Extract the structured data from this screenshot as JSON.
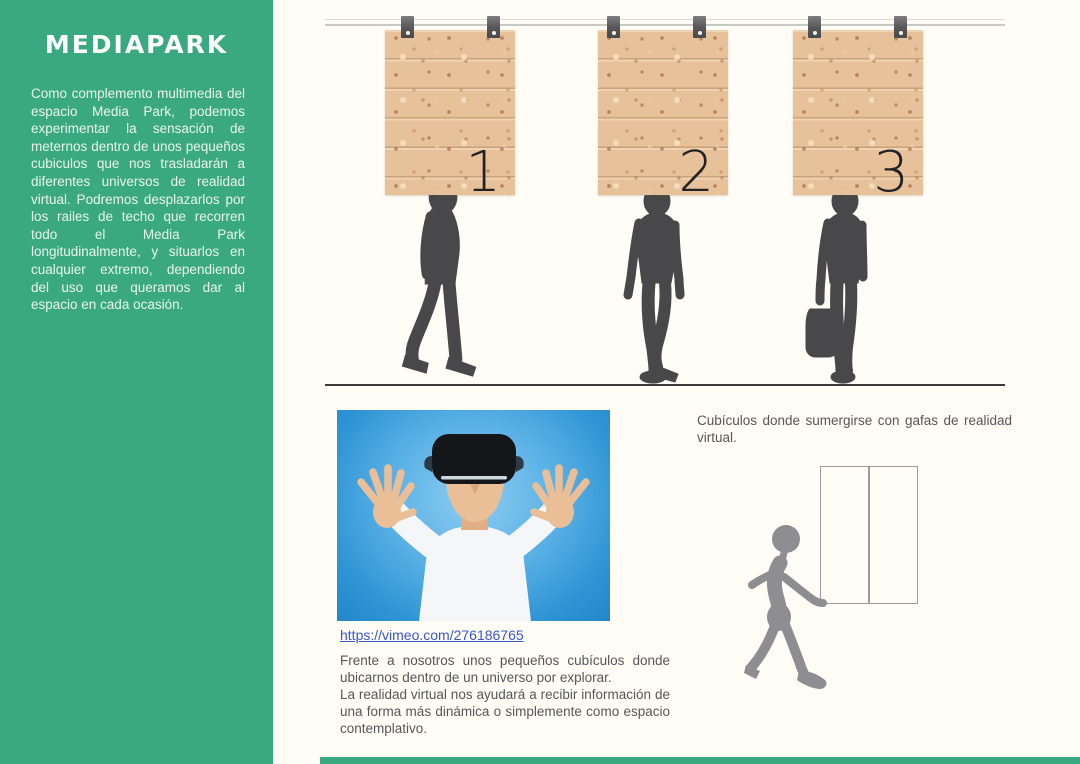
{
  "sidebar": {
    "title": "MEDIAPARK",
    "paragraph": "Como complemento multimedia del espacio Media Park, podemos experimentar la sensación de meternos dentro de unos pequeños cubiculos que nos trasladarán a diferentes universos de realidad virtual. Podremos desplazarlos por los railes de techo que recorren todo el Media Park longitudinalmente, y situarlos en cualquier extremo, dependiendo del uso que queramos dar al espacio en cada ocasión."
  },
  "rail_diagram": {
    "panels": [
      {
        "number": "1"
      },
      {
        "number": "2"
      },
      {
        "number": "3"
      }
    ]
  },
  "video": {
    "link_text": "https://vimeo.com/276186765"
  },
  "captions": {
    "right": "Cubículos donde sumergirse con gafas de realidad virtual.",
    "left_para1": "Frente a nosotros unos pequeños cubículos donde ubicarnos dentro de un universo por explorar.",
    "left_para2": "La realidad virtual nos ayudará a recibir información de una forma más dinámica o simplemente como espacio contemplativo."
  },
  "colors": {
    "sidebar_green": "#3aa982",
    "cork_panel": "#e6c199",
    "silhouette_gray": "#48484a",
    "sketch_gray": "#8d8d92",
    "link_blue": "#3a56c8",
    "body_text_gray": "#55565a",
    "photo_blue": "#2e94d4",
    "page_background": "#fffdf6"
  }
}
